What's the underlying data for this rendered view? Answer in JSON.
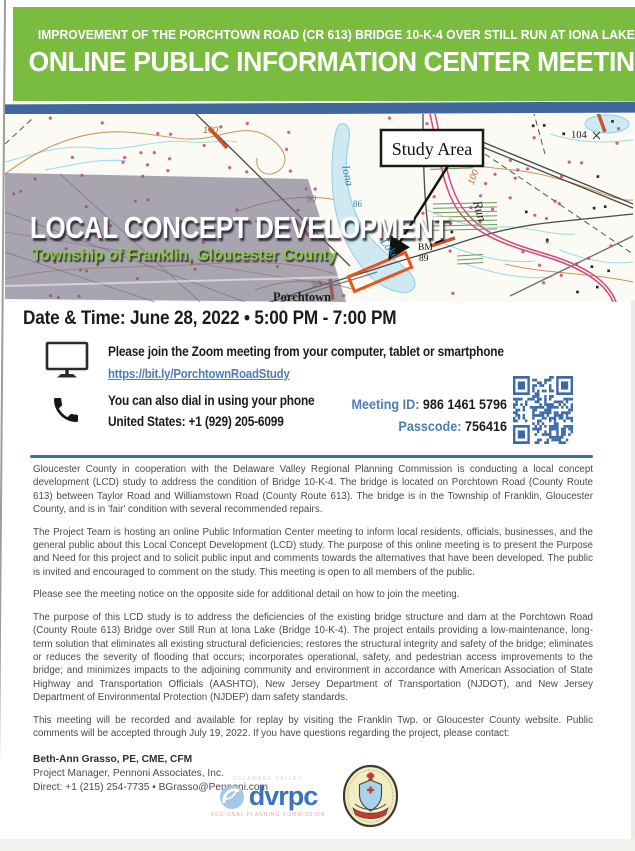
{
  "header": {
    "line1": "IMPROVEMENT OF THE PORCHTOWN ROAD (CR 613) BRIDGE 10-K-4 OVER STILL RUN AT IONA LAKE",
    "line2": "ONLINE PUBLIC INFORMATION CENTER MEETING"
  },
  "map": {
    "study_area": "Study Area",
    "title": "LOCAL CONCEPT DEVELOPMENT",
    "subtitle": "Township of Franklin, Gloucester County",
    "labels": {
      "iona": "Iona",
      "lake": "Lake",
      "run": "Run",
      "town": "Porchtown",
      "bm_top": "BM",
      "bm_bottom": "89",
      "depth_86": "86",
      "contour_90": "90",
      "contour_98": "98",
      "contour_100_left": "100",
      "contour_100_right": "100",
      "elevation_104": "104"
    }
  },
  "meeting": {
    "datetime": "Date & Time: June 28, 2022 • 5:00 PM - 7:00 PM",
    "zoom_instruction": "Please join the Zoom meeting from your computer, tablet or smartphone",
    "zoom_link": "https://bit.ly/PorchtownRoadStudy",
    "phone_instruction": "You can also dial in using your phone",
    "phone_number": "United States: +1 (929) 205-6099",
    "meeting_id_label": "Meeting ID:",
    "meeting_id_value": "986 1461 5796",
    "passcode_label": "Passcode:",
    "passcode_value": "756416"
  },
  "paragraphs": [
    "Gloucester County in cooperation with the Delaware Valley Regional Planning Commission is conducting a local concept development (LCD) study to address the condition of Bridge 10-K-4. The bridge is located on Porchtown Road (County Route 613) between Taylor Road and Williamstown Road (County Route 613). The bridge is in the Township of Franklin, Gloucester County, and is in 'fair' condition with several recommended repairs.",
    "The Project Team is hosting an online Public Information Center meeting to inform local residents, officials, businesses, and the general public about this Local Concept Development (LCD) study. The purpose of this online meeting is to present the Purpose and Need for this project and to solicit public input and comments towards the alternatives that have been developed. The public is invited and encouraged to comment on the study. This meeting is open to all members of the public.",
    "Please see the meeting notice on the opposite side for additional detail on how to join the meeting.",
    "The purpose of this LCD study is to address the deficiencies of the existing bridge structure and dam at the Porchtown Road (County Route 613) Bridge over Still Run at Iona Lake (Bridge 10-K-4). The project entails providing a low-maintenance, long-term solution that eliminates all existing structural deficiencies; restores the structural integrity and safety of the bridge; eliminates or reduces the severity of flooding that occurs; incorporates operational, safety, and pedestrian access improvements to the bridge; and minimizes impacts to the adjoining community and environment in accordance with American Association of State Highway and Transportation Officials (AASHTO), New Jersey Department of Transportation (NJDOT), and New Jersey Department of Environmental Protection (NJDEP) dam safety standards.",
    "This meeting will be recorded and available for replay by visiting the Franklin Twp. or Gloucester County website. Public comments will be accepted through July 19, 2022. If you have questions regarding the project, please contact:"
  ],
  "contact": {
    "name": "Beth-Ann Grasso, PE, CME, CFM",
    "role": "Project Manager, Pennoni Associates, Inc.",
    "direct": "Direct: +1 (215) 254-7735 • BGrasso@Pennoni.com"
  },
  "footer": {
    "dvrpc_name": "dvrpc",
    "dvrpc_top": "DELAWARE VALLEY",
    "dvrpc_bottom": "REGIONAL PLANNING COMMISSION"
  },
  "colors": {
    "header_green": "#7abc3f",
    "bar_blue": "#41689e",
    "link_blue": "#4d7db5",
    "qr_blue": "#3a6ba8",
    "subtitle_green": "#8dc63f",
    "study_highlight_orange": "#e8541d",
    "divider_blue": "#3a6ca5"
  }
}
